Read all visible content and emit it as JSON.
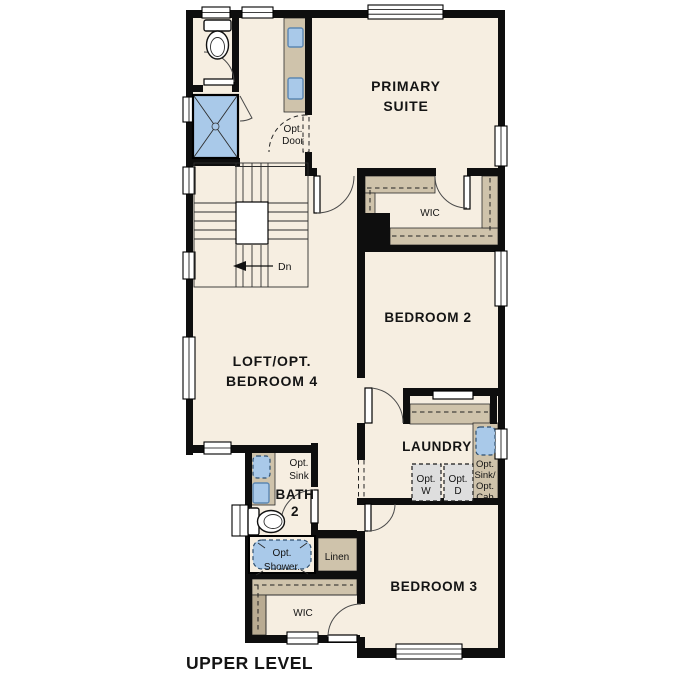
{
  "title": "UPPER LEVEL",
  "rooms": {
    "primary_suite": {
      "lines": [
        "PRIMARY",
        "SUITE"
      ]
    },
    "primary_wic": {
      "label": "WIC"
    },
    "bedroom_2": {
      "label": "BEDROOM 2"
    },
    "loft": {
      "lines": [
        "LOFT/OPT.",
        "BEDROOM 4"
      ]
    },
    "bath_2": {
      "lines": [
        "BATH",
        "2"
      ]
    },
    "laundry": {
      "label": "LAUNDRY"
    },
    "linen": {
      "label": "Linen"
    },
    "bedroom_3_wic": {
      "label": "WIC"
    },
    "bedroom_3": {
      "label": "BEDROOM 3"
    }
  },
  "annotations": {
    "stair_direction": "Dn",
    "opt_door": {
      "lines": [
        "Opt.",
        "Door"
      ]
    },
    "opt_sink": {
      "lines": [
        "Opt.",
        "Sink"
      ]
    },
    "opt_shower": {
      "lines": [
        "Opt.",
        "Shower."
      ]
    },
    "opt_washer": {
      "lines": [
        "Opt.",
        "W"
      ]
    },
    "opt_dryer": {
      "lines": [
        "Opt.",
        "D"
      ]
    },
    "opt_sink_cab": {
      "lines": [
        "Opt.",
        "Sink/",
        "Opt.",
        "Cab"
      ]
    }
  },
  "colors": {
    "floor": "#f6eee1",
    "wall": "#0e0e0e",
    "casework": "#cfc3ab",
    "casework_dark": "#b9ab92",
    "fixture_blue": "#a9c9e9",
    "fixture_blue_dark": "#5c87b2",
    "appliance_gray": "#dedede",
    "outside": "#ffffff"
  }
}
